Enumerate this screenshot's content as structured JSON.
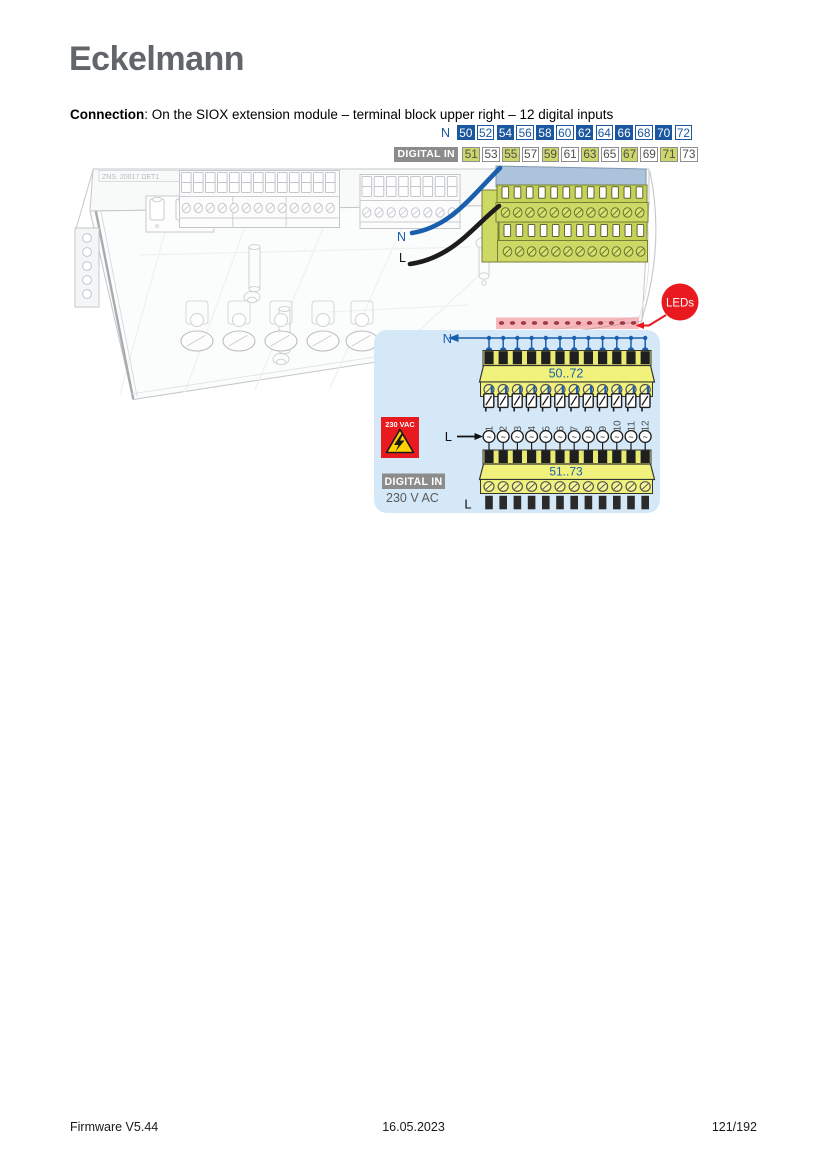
{
  "header": {
    "logo": "Eckelmann"
  },
  "title": {
    "bold": "Connection",
    "rest": ": On the SIOX extension module – terminal block upper right – 12 digital inputs"
  },
  "terminal_header": {
    "n_label": "N",
    "n_terminals": [
      "50",
      "52",
      "54",
      "56",
      "58",
      "60",
      "62",
      "64",
      "66",
      "68",
      "70",
      "72"
    ],
    "digital_in_label": "DIGITAL IN",
    "digital_terminals": [
      "51",
      "53",
      "55",
      "57",
      "59",
      "61",
      "63",
      "65",
      "67",
      "69",
      "71",
      "73"
    ]
  },
  "module_drawing": {
    "plate_label": "ZNS. 20017 DET1",
    "wire_n_label": "N",
    "wire_l_label": "L",
    "leds_label": "LEDs",
    "led_count": 13
  },
  "callout": {
    "n_bus_label": "N",
    "upper_block_range": "50..72",
    "channel_numbers": [
      "1",
      "2",
      "3",
      "4",
      "5",
      "6",
      "7",
      "8",
      "9",
      "10",
      "11",
      "12"
    ],
    "l_feed_label": "L",
    "lower_block_range": "51..73",
    "l_bottom_label": "L",
    "warning_label": "230 VAC",
    "digital_in_badge": "DIGITAL IN",
    "voltage_label": "230 V AC"
  },
  "footer": {
    "left": "Firmware V5.44",
    "center": "16.05.2023",
    "right": "121/192"
  },
  "colors": {
    "accent_blue": "#1a579f",
    "wire_blue": "#1a5fae",
    "terminal_yellow": "#ccd66b",
    "block_yellow": "#f1f27c",
    "warning_red": "#e8191f",
    "callout_bg": "#d4e8f7",
    "badge_gray": "#8c8c8c",
    "logo_gray": "#62666b"
  }
}
